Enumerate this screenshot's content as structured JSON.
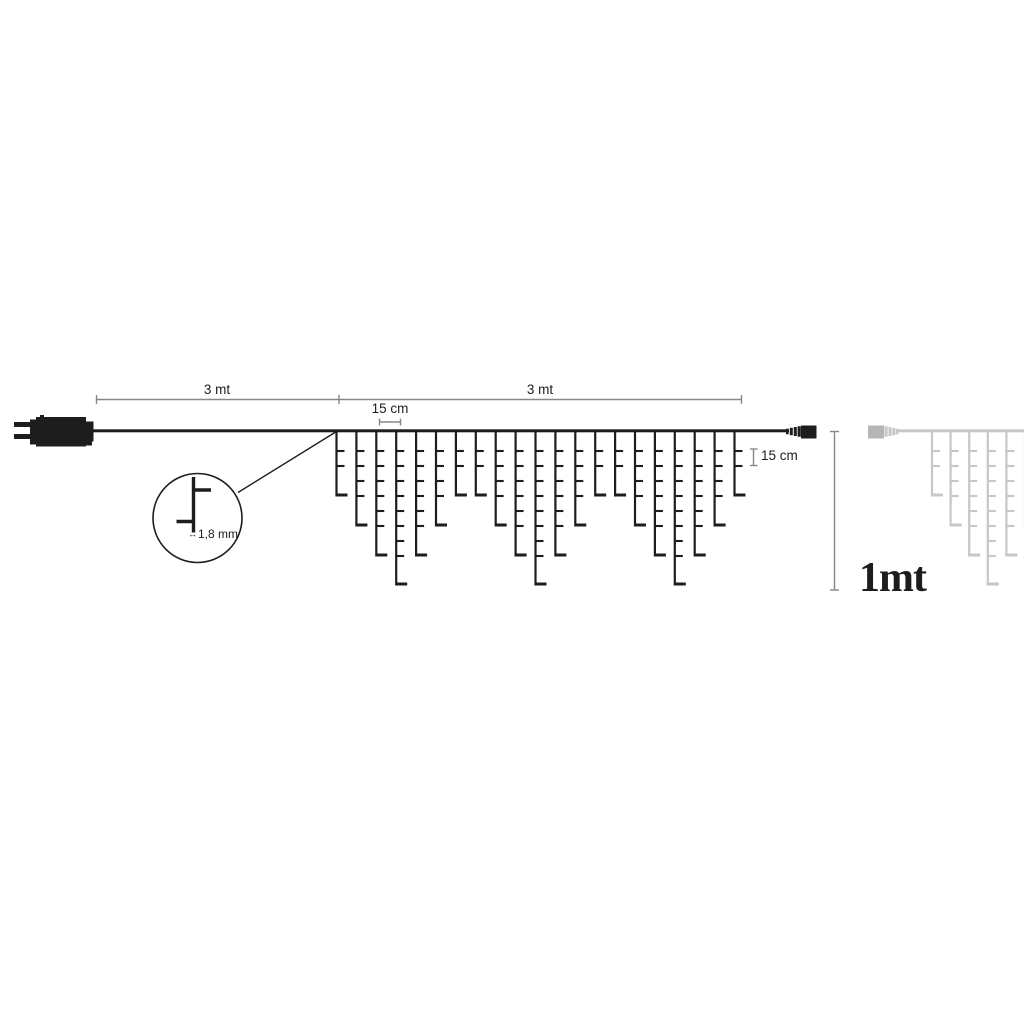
{
  "labels": {
    "lead_length": "3 mt",
    "lit_length": "3 mt",
    "drop_spacing": "15 cm",
    "led_spacing": "15 cm",
    "wire_diameter": "1,8 mm",
    "drop_height": "1mt",
    "width_arrow_icon": "↔"
  },
  "colors": {
    "line": "#1d1d1b",
    "dim": "#878787",
    "faded": "#c7c7c7",
    "faded_dark": "#b5b5b5",
    "bg": "#ffffff"
  },
  "diagram": {
    "wire_y": 430.5,
    "led": {
      "first_row_y": 451,
      "row_spacing": 15,
      "tick_len": 8,
      "foot_len": 11,
      "foot_gap": 26
    },
    "strings": {
      "main": {
        "x_start": 336.5,
        "spacing": 19.9,
        "drop_count": 21,
        "depth_cycle": [
          66,
          96,
          126,
          155,
          126,
          96,
          66
        ]
      },
      "preview": {
        "x_start": 932,
        "spacing": 18.6,
        "drop_count": 6,
        "depth_cycle": [
          66,
          96,
          126,
          155,
          126,
          96
        ]
      }
    }
  }
}
